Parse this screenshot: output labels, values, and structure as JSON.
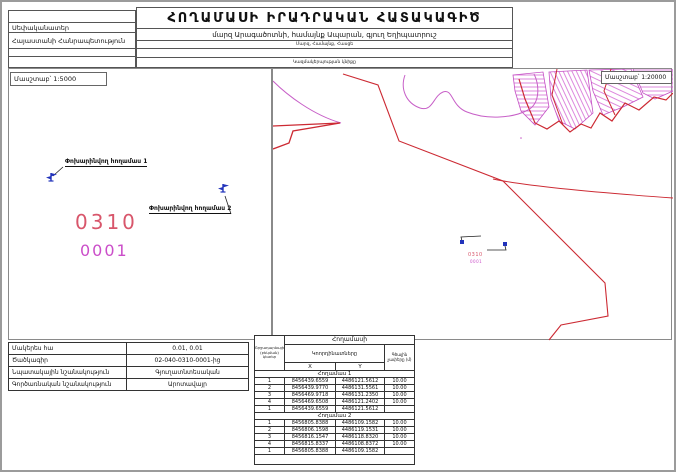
{
  "header": {
    "owner_label": "Սեփականատեր",
    "owner_value": "Հայաստանի Հանրապետություն",
    "title": "ՀՈՂԱՄԱՍԻ ԻՐԱԴՐԱԿԱՆ ՀԱՏԱԿԱԳԻԾ",
    "subtitle": "մարզ Արագածոտնի, համայնք Ապարան, գյուղ Եղիպատրուշ",
    "subtitle_caption": "Մարզ, Համայնք, Հասցե",
    "stamp_caption": "Կազմակերպության կնիքը"
  },
  "left_map": {
    "scale_label": "Մասշտաբ՝ 1:5000",
    "flag1_label": "Փոխարինվող հողամաս 1",
    "flag2_label": "Փոխարինվող հողամաս 2",
    "parcel_code": "0310",
    "parcel_number": "0001"
  },
  "right_map": {
    "scale_label": "Մասշտաբ՝ 1:20000",
    "parcel_code": "0310",
    "parcel_number": "0001"
  },
  "info_table": {
    "rows": [
      {
        "label": "Մակերես հա",
        "value": "0.01, 0.01"
      },
      {
        "label": "Ծածկագիր",
        "value": "02-040-0310-0001-ից"
      },
      {
        "label": "Նպատակային նշանակություն",
        "value": "Գյուղատնտեսական"
      },
      {
        "label": "Գործառնական նշանակություն",
        "value": "Արոտավայր"
      }
    ]
  },
  "coords_table": {
    "title": "Հողամասի",
    "col_points": "Շրջադարձային (բեկման) կետեր",
    "col_coords": "Կոորդինատները",
    "col_length": "Գծային չափերը (մ)",
    "col_x": "X",
    "col_y": "Y",
    "sections": [
      {
        "name": "Հողամաս 1",
        "rows": [
          {
            "n": "1",
            "x": "8456439.6559",
            "y": "4486121.5612",
            "d": "10.00"
          },
          {
            "n": "2",
            "x": "8456439.9770",
            "y": "4486131.5561",
            "d": "10.00"
          },
          {
            "n": "3",
            "x": "8456469.9718",
            "y": "4486131.2350",
            "d": "10.00"
          },
          {
            "n": "4",
            "x": "8456469.6508",
            "y": "4486121.2402",
            "d": "10.00"
          },
          {
            "n": "1",
            "x": "8456439.6559",
            "y": "4486121.5612",
            "d": ""
          }
        ]
      },
      {
        "name": "Հողամաս 2",
        "rows": [
          {
            "n": "1",
            "x": "8456805.8388",
            "y": "4486109.1582",
            "d": "10.00"
          },
          {
            "n": "2",
            "x": "8456806.1598",
            "y": "4486119.1531",
            "d": "10.00"
          },
          {
            "n": "3",
            "x": "8456816.1547",
            "y": "4486118.8320",
            "d": "10.00"
          },
          {
            "n": "4",
            "x": "8456815.8337",
            "y": "4486108.8372",
            "d": "10.00"
          },
          {
            "n": "1",
            "x": "8456805.8388",
            "y": "4486109.1582",
            "d": ""
          }
        ]
      }
    ]
  },
  "colors": {
    "boundary_red": "#cc2a33",
    "contour_magenta": "#c75fc7",
    "parcel_code_red": "#d8566b",
    "parcel_number_magenta": "#cb4ec9",
    "flag_blue": "#2233bb"
  }
}
